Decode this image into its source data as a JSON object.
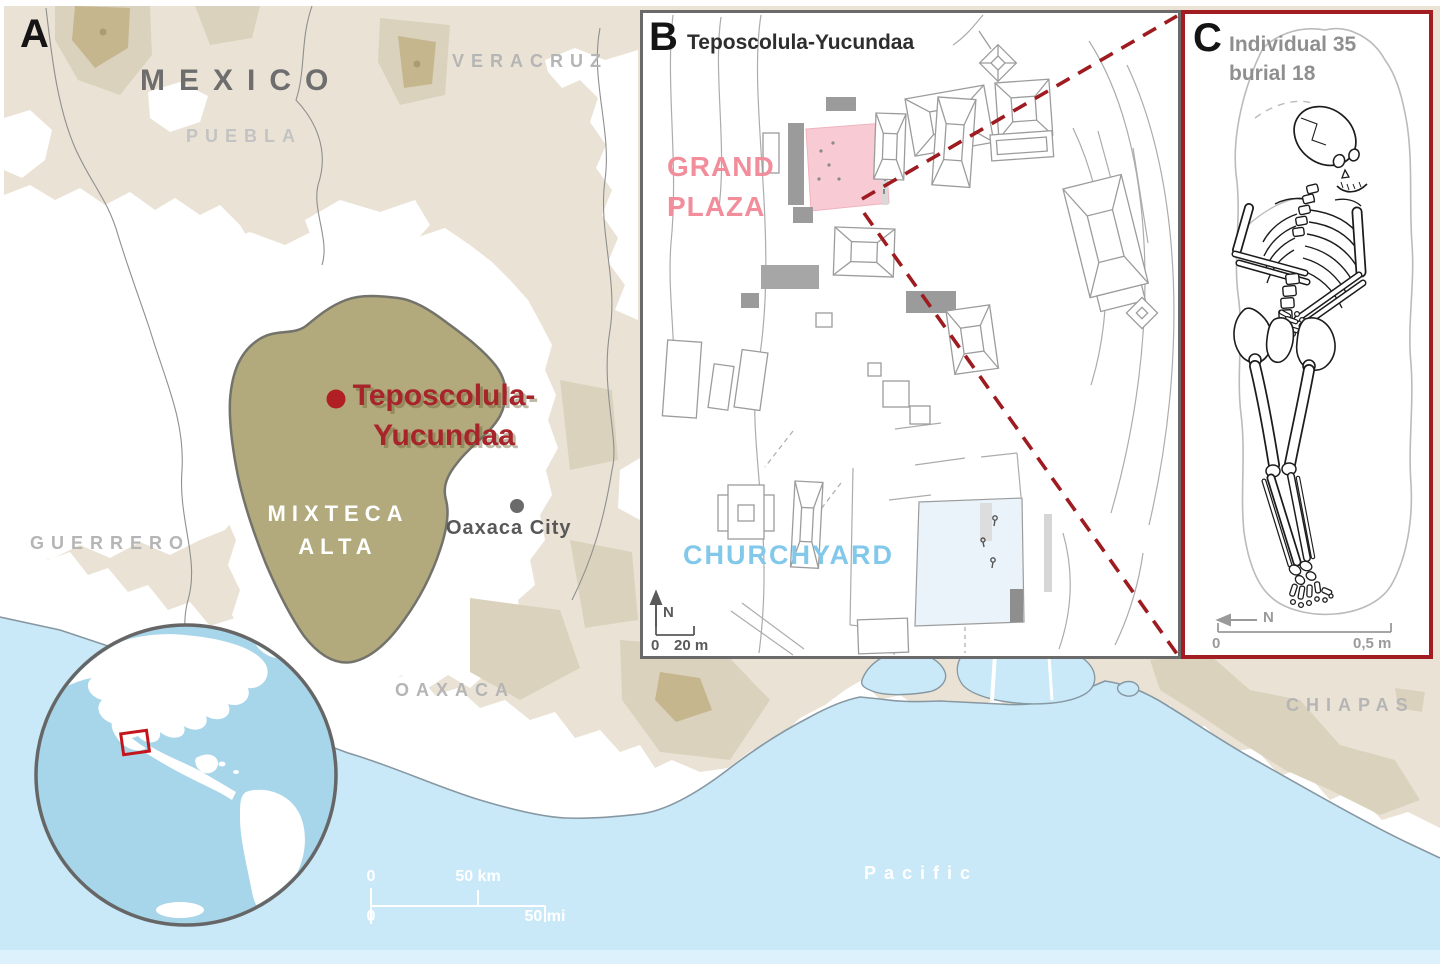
{
  "panel_a": {
    "label": "A",
    "country": "MEXICO",
    "state_veracruz": "VERACRUZ",
    "state_puebla": "PUEBLA",
    "state_guerrero": "GUERRERO",
    "state_oaxaca": "OAXACA",
    "state_chiapas": "CHIAPAS",
    "region_line1": "MIXTECA",
    "region_line2": "ALTA",
    "site_line1": "Teposcolula-",
    "site_line2": "Yucundaa",
    "city": "Oaxaca City",
    "ocean": "Pacific",
    "scale_km_zero": "0",
    "scale_km": "50 km",
    "scale_mi_zero": "0",
    "scale_mi": "50 mi"
  },
  "panel_b": {
    "label": "B",
    "title": "Teposcolula-Yucundaa",
    "plaza_line1": "GRAND",
    "plaza_line2": "PLAZA",
    "churchyard": "CHURCHYARD",
    "north": "N",
    "scale_zero": "0",
    "scale_value": "20 m"
  },
  "panel_c": {
    "label": "C",
    "title_line1": "Individual 35",
    "title_line2": "burial 18",
    "north": "N",
    "scale_zero": "0",
    "scale_value": "0,5 m"
  },
  "colors": {
    "accent_red": "#A8242B",
    "dashed_line_red": "#9E1B20",
    "plaza_pink_text": "#F28E9B",
    "plaza_pink_fill": "#F8CAD3",
    "churchyard_blue_text": "#82C8EA",
    "churchyard_blue_fill": "#EAF3FA",
    "region_olive": "#B2AA7C",
    "land_beige": "#EAE3D5",
    "ocean_blue": "#C9E9F8",
    "globe_ocean": "#A7D5E9"
  }
}
